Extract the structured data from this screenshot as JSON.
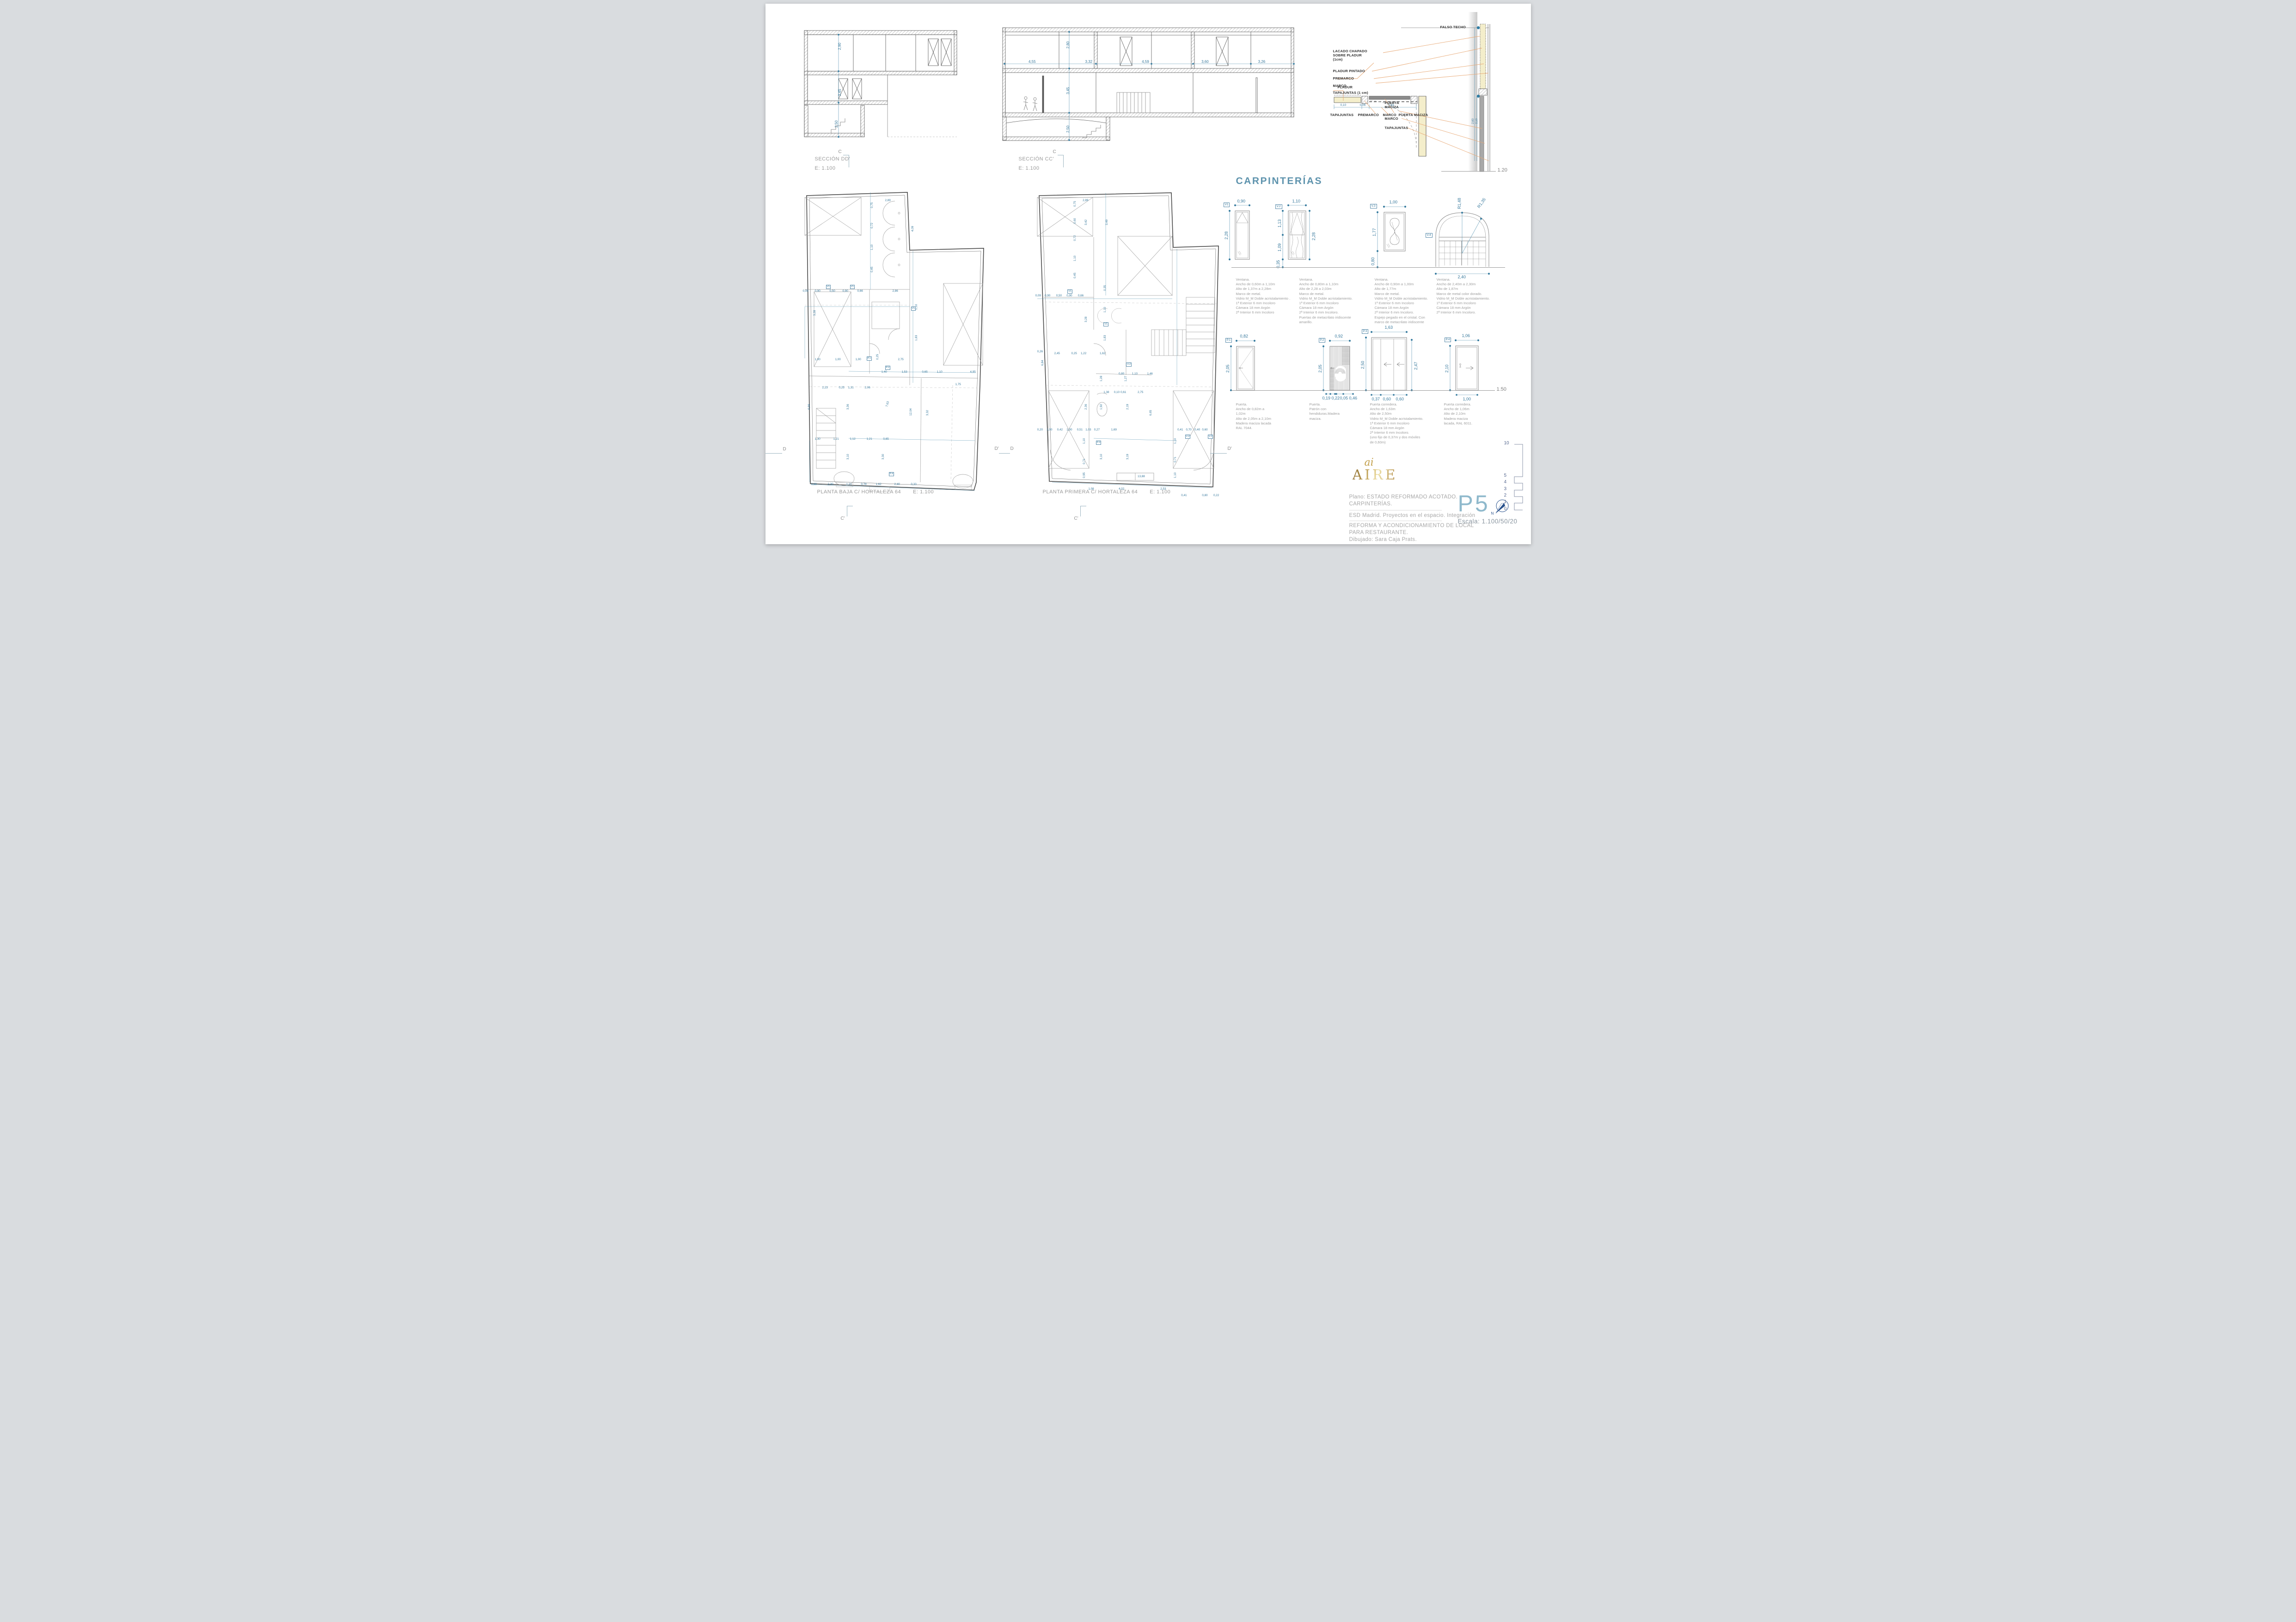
{
  "colors": {
    "dim_blue": "#36789c",
    "heading_blue": "#5e93ad",
    "sheet_blue": "#8fb9cc",
    "gold": "#cfa94e",
    "green": "#2e7d46",
    "leader_orange": "#e8a874"
  },
  "sections": {
    "dd": {
      "label": "SECCIÓN DD'",
      "scale": "E: 1.100",
      "dims": [
        [
          "2,90",
          24,
          20,
          -90
        ],
        [
          "3,45",
          24,
          60,
          -90
        ],
        [
          "2,50",
          22,
          87,
          -90
        ]
      ]
    },
    "cc": {
      "label": "SECCIÓN CC'",
      "scale": "E: 1.100",
      "dims": [
        [
          "2,80",
          22.5,
          22,
          -90
        ],
        [
          "3,45",
          22.5,
          60,
          -90
        ],
        [
          "2,50",
          22.5,
          92,
          -90
        ],
        [
          "4,55",
          10,
          31,
          0
        ],
        [
          "3,32",
          29,
          31,
          0
        ],
        [
          "4,59",
          48,
          31,
          0
        ],
        [
          "3,60",
          68,
          31,
          0
        ],
        [
          "3,26",
          87,
          31,
          0
        ]
      ]
    }
  },
  "detail": {
    "falso_techo": "FALSO TECHO",
    "lacado": [
      "LACADO CHAPADO",
      "SOBRE PLADUR",
      "(1cm)"
    ],
    "pladur_pintado": "PLADUR PINTADO",
    "premarco": "PREMARCO",
    "marco1": "MARCO",
    "tapajuntas1": "TAPAJUNTAS (1 cm)",
    "puerta_maciza": [
      "PUERTA",
      "MACIZA"
    ],
    "marco2": "MARCO",
    "tapajuntas2": "TAPAJUNTAS",
    "pladur": "PLADUR",
    "row_tapajuntas": "TAPAJUNTAS",
    "row_premarco": "PREMARCO",
    "row_marco": "MARCO",
    "row_puerta": "PUERTA MACIZA",
    "dim1": "0,10",
    "dim2": "0,06",
    "dim3": "0,81",
    "vdim1": "2,60",
    "vdim2": "2,10",
    "ground_scale": "1.20"
  },
  "carpinterias": {
    "title": "CARPINTERÍAS",
    "ground_scale": "1.50",
    "windows": [
      {
        "tag": "V1",
        "width": "0,90",
        "height": "2,28",
        "desc": [
          "Ventana.",
          "Ancho de 0,60m a 1,10m",
          "Alto de 1,37m a 2,28m",
          "Marco de metal.",
          "Vidrio M_M Doble acristalamiento .",
          "1ª Exterior 6 mm Incoloro",
          "Cámara 18 mm Argón",
          "2ª Interior 6 mm Incoloro"
        ]
      },
      {
        "tag": "V.2",
        "width": "1,10",
        "h_upper": "1,13",
        "h_lower": "1,09",
        "h_sill": "0,35",
        "height": "2,28",
        "desc": [
          "Ventana.",
          "Ancho de 0,80m a 1,10m",
          "Alto de 2,28 a 2,03m",
          "Marco de metal.",
          "Vidrio M_M Doble acristalamiento.",
          "1ª Exterior 6 mm Incoloro",
          "Cámara 18 mm Argón",
          "2ª Interior 6 mm Incoloro.",
          "Puertas de metacrilato iridiscente",
          "amarillo."
        ]
      },
      {
        "tag": "V.3",
        "width": "1,00",
        "height": "1,77",
        "h_sill": "0,80",
        "desc": [
          "Ventana.",
          "Ancho de 0,90m a 1,00m",
          "Alto de 1,77m",
          "Marco de metal.",
          "Vidrio M_M Doble acristalamiento.",
          "1ª Exterior 6 mm Incoloro",
          "Cámara 18 mm Argón",
          "2ª Interior 6 mm Incoloro.",
          "Espejo pegado en el cristal. Con",
          "marco de metacrilato iridiscente"
        ]
      },
      {
        "tag": "V.4",
        "width": "2,40",
        "r1": "R1,48",
        "r2": "R1,35",
        "desc": [
          "Ventana.",
          "Ancho de 2,40m a 2,30m",
          "Alto de 1,87m",
          "Marco de metal color dorado.",
          "Vidrio M_M Doble acristalamiento.",
          "1ª Exterior 6 mm Incoloro",
          "Cámara 18 mm Argón",
          "2ª Interior 6 mm Incoloro."
        ]
      }
    ],
    "doors": [
      {
        "tag": "P.1",
        "width": "0,82",
        "height": "2,05",
        "desc": [
          "Puerta.",
          "Ancho de 0,82m a",
          "1,02m",
          "Alto de 2,05m a 2,10m",
          "Madera maciza lacada",
          "RAL 7044."
        ]
      },
      {
        "tag": "P.2",
        "width": "0,92",
        "height": "2,05",
        "b1": "0,19",
        "b2": "0,22",
        "b3": "0,05",
        "b4": "0,46",
        "desc": [
          "Puerta.",
          "Patrón con",
          "hendiduras.Madera",
          "maciza."
        ]
      },
      {
        "tag": "P.3",
        "width": "1,63",
        "height_l": "2,50",
        "height_r": "2,47",
        "b1": "0,37",
        "b2": "0,60",
        "b3": "0,60",
        "desc": [
          "Puerta corredera.",
          "Ancho de 1,63m",
          "Alto de 2,50m",
          "Vidrio M_M Doble acristalamiento.",
          "1ª Exterior 6 mm Incoloro",
          "Cámara 18 mm Argón",
          "2ª Interior 6 mm Incoloro.",
          "(uno fijo de 0,37m y dos móviles",
          "de 0,60m)"
        ]
      },
      {
        "tag": "P.4",
        "width": "1,06",
        "height": "2,10",
        "b1": "1,00",
        "desc": [
          "Puerta corredera.",
          "Ancho de 1,06m",
          "Alto de 2,10m",
          "Madera maciza",
          "lacada, RAL 6011."
        ]
      }
    ]
  },
  "plans": [
    {
      "label": "PLANTA BAJA C/ HORTALEZA 64",
      "scale": "E: 1.100",
      "dims": [
        [
          "2,89",
          46,
          2.5
        ],
        [
          "0,75",
          38,
          5.5,
          -90
        ],
        [
          "0,72",
          38,
          12,
          -90
        ],
        [
          "1,10",
          38,
          19,
          -90
        ],
        [
          "0,45",
          38,
          26,
          -90
        ],
        [
          "4,09",
          60,
          13,
          -90
        ],
        [
          "0,09",
          1.5,
          31.5
        ],
        [
          "0,90",
          8,
          31.5
        ],
        [
          "0,50",
          16,
          31.5
        ],
        [
          "0,90",
          23,
          31.5
        ],
        [
          "0,66",
          31,
          31.5
        ],
        [
          "2,86",
          50,
          31.5
        ],
        [
          "V1",
          14,
          30,
          0,
          "tag"
        ],
        [
          "V1",
          27,
          30,
          0,
          "tag"
        ],
        [
          "V1",
          60,
          37,
          0,
          "tag"
        ],
        [
          "3,28",
          7,
          40,
          -90
        ],
        [
          "1,10",
          62,
          38,
          -90
        ],
        [
          "1,83",
          62,
          48,
          -90
        ],
        [
          "1,00",
          8,
          53.5
        ],
        [
          "1,00",
          19,
          53.5
        ],
        [
          "1,00",
          30,
          53.5
        ],
        [
          "2,75",
          53,
          53.5
        ],
        [
          "0,25",
          41,
          54,
          -90
        ],
        [
          "P.1",
          36,
          53,
          0,
          "tag"
        ],
        [
          "P.2",
          46,
          56,
          0,
          "tag"
        ],
        [
          "1,40",
          44,
          57.5
        ],
        [
          "1,53",
          55,
          57.5
        ],
        [
          "0,65",
          66,
          57.5
        ],
        [
          "1,10",
          74,
          57.5
        ],
        [
          "4,95",
          92,
          57.5
        ],
        [
          "2,23",
          12,
          62.5
        ],
        [
          "0,25",
          21,
          62.5
        ],
        [
          "1,31",
          26,
          62.5
        ],
        [
          "2,06",
          35,
          62.5
        ],
        [
          "3,36",
          25,
          70,
          -90
        ],
        [
          "7,63",
          46,
          69,
          -75
        ],
        [
          "12,04",
          59,
          72,
          -90
        ],
        [
          "3,32",
          68,
          72,
          -90
        ],
        [
          "1,75",
          84,
          61.5
        ],
        [
          "1,30",
          8,
          79
        ],
        [
          "1,21",
          18,
          79
        ],
        [
          "1,12",
          27,
          79
        ],
        [
          "1,21",
          36,
          79
        ],
        [
          "0,65",
          45,
          79
        ],
        [
          "3,10",
          25,
          86,
          -90
        ],
        [
          "3,30",
          44,
          86,
          -90
        ],
        [
          "6,66",
          4,
          70,
          -90
        ],
        [
          "0,88",
          6,
          93.5
        ],
        [
          "2,30",
          15,
          93.5
        ],
        [
          "1,21",
          25,
          93.5
        ],
        [
          "0,78",
          33,
          93.5
        ],
        [
          "1,62",
          41,
          93.5
        ],
        [
          "2,40",
          51,
          93.5
        ],
        [
          "0,33",
          60,
          93.5
        ],
        [
          "P.4",
          48,
          90,
          0,
          "tag"
        ]
      ]
    },
    {
      "label": "PLANTA PRIMERA C/ HORTALEZA 64",
      "scale": "E: 1.100",
      "dims": [
        [
          "2,89",
          26,
          2.5
        ],
        [
          "3,49",
          38,
          11,
          -90
        ],
        [
          "3,42",
          27,
          11,
          -90
        ],
        [
          "0,75",
          21,
          5,
          -90
        ],
        [
          "0,60",
          21,
          10.5,
          -90
        ],
        [
          "0,72",
          21,
          16,
          -90
        ],
        [
          "1,10",
          21,
          22.5,
          -90
        ],
        [
          "0,45",
          21,
          28,
          -90
        ],
        [
          "0,09",
          1,
          33
        ],
        [
          "0,90",
          6,
          33
        ],
        [
          "0,50",
          12,
          33
        ],
        [
          "0,90",
          17.5,
          33
        ],
        [
          "0,66",
          23.5,
          33
        ],
        [
          "V1",
          18,
          31.5,
          0,
          "tag"
        ],
        [
          "V1",
          37,
          42,
          0,
          "tag"
        ],
        [
          "V.2",
          49,
          55,
          0,
          "tag"
        ],
        [
          "0,26",
          2,
          51
        ],
        [
          "2,45",
          11,
          51.5
        ],
        [
          "0,25",
          20,
          51.5
        ],
        [
          "1,22",
          25,
          51.5
        ],
        [
          "1,62",
          35,
          51.5
        ],
        [
          "6,84",
          4,
          56,
          -90
        ],
        [
          "3,28",
          27,
          42,
          -90
        ],
        [
          "1,10",
          37,
          39,
          -90
        ],
        [
          "1,83",
          37,
          48,
          -90
        ],
        [
          "0,35",
          37,
          32,
          -90
        ],
        [
          "0,80",
          45,
          58
        ],
        [
          "1,10",
          52,
          58
        ],
        [
          "1,46",
          60,
          58
        ],
        [
          "2,75",
          55,
          64
        ],
        [
          "1,27",
          48,
          61,
          -90
        ],
        [
          "1,28",
          35,
          61,
          -90
        ],
        [
          "1,38",
          37,
          64
        ],
        [
          "0,10",
          42.5,
          64
        ],
        [
          "0,61",
          46,
          64
        ],
        [
          "6,65",
          61,
          72,
          -90
        ],
        [
          "2,19",
          49,
          70,
          -90
        ],
        [
          "1,92",
          35,
          70,
          -90
        ],
        [
          "2,36",
          27,
          70,
          -90
        ],
        [
          "1,69",
          41,
          76
        ],
        [
          "0,20",
          2,
          76
        ],
        [
          "1,00",
          7,
          76
        ],
        [
          "0,42",
          12.5,
          76
        ],
        [
          "1,00",
          17.5,
          76
        ],
        [
          "0,51",
          23,
          76
        ],
        [
          "1,03",
          27.5,
          76
        ],
        [
          "0,27",
          32,
          76
        ],
        [
          "0,41",
          76,
          76
        ],
        [
          "0,70",
          80.5,
          76
        ],
        [
          "0,40",
          85,
          76
        ],
        [
          "0,60",
          89,
          76
        ],
        [
          "V.2",
          80,
          78,
          0,
          "tag"
        ],
        [
          "V.2",
          92,
          78,
          0,
          "tag"
        ],
        [
          "P.3",
          33,
          80,
          0,
          "tag"
        ],
        [
          "3,10",
          35,
          86,
          -90
        ],
        [
          "3,19",
          49,
          86,
          -90
        ],
        [
          "1,10",
          26,
          81,
          -90
        ],
        [
          "0,71",
          26,
          87.5,
          -90
        ],
        [
          "0,95",
          26,
          92,
          -90
        ],
        [
          "1,10",
          74,
          81,
          -90
        ],
        [
          "0,71",
          74,
          87,
          -90
        ],
        [
          "1,10",
          74,
          92,
          -90
        ],
        [
          "1,08",
          29,
          95
        ],
        [
          "4,02",
          45,
          95
        ],
        [
          "13,88",
          55,
          91
        ],
        [
          "2,53",
          67,
          95
        ],
        [
          "0,41",
          78,
          97
        ],
        [
          "0,80",
          89,
          97
        ],
        [
          "0,22",
          95,
          97
        ]
      ]
    }
  ],
  "markers": {
    "c": "C",
    "c2": "C",
    "c_prime1": "C'",
    "c_prime2": "C'",
    "d1": "D",
    "d_prime1": "D'",
    "d2": "D",
    "d_prime2": "D'"
  },
  "titleblock": {
    "logo_small": "ai",
    "logo": "AIRE",
    "plano_line1": "Plano: ESTADO REFORMADO ACOTADO.",
    "plano_line2": "CARPINTERÍAS.",
    "school": "ESD Madrid. Proyectos en el espacio. Integración",
    "project_line1": "REFORMA  Y ACONDICIONAMIENTO DE LOCAL",
    "project_line2": "PARA RESTAURANTE.",
    "author": "Dibujado: Sara Caja Prats.",
    "sheet": "P5",
    "escala": "Escala: 1.100/50/20",
    "north": "N"
  },
  "scalebar": {
    "values": [
      [
        "10",
        0
      ],
      [
        "5",
        70
      ],
      [
        "4",
        84
      ],
      [
        "3",
        99
      ],
      [
        "2",
        113
      ],
      [
        "1",
        127
      ],
      [
        "0",
        142
      ]
    ]
  }
}
